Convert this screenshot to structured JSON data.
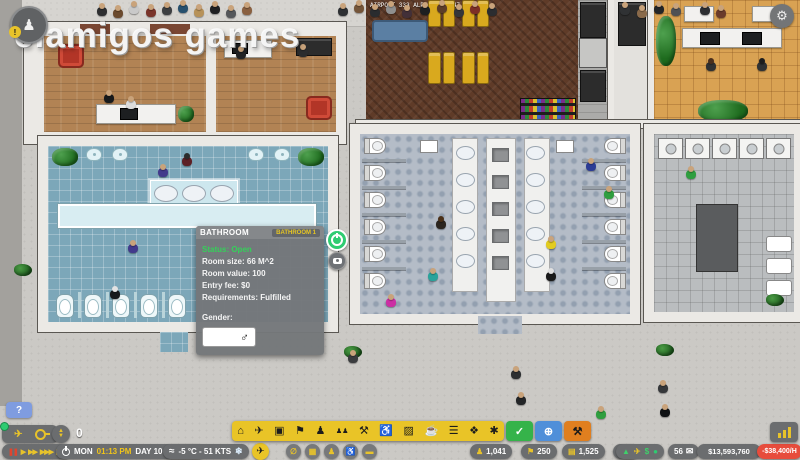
{
  "watermark": "elamigos  games",
  "world": {
    "flight_label": "AIRPORT 333 ALPHA 33.7-47"
  },
  "panel": {
    "title": "BATHROOM",
    "badge": "BATHROOM 1",
    "status": "Status: Open",
    "lines": [
      "Room size: 66 M^2",
      "Room value: 100",
      "Entry fee: $0",
      "Requirements: Fulfilled"
    ],
    "gender_label": "Gender:",
    "gender_symbol": "♂"
  },
  "hud": {
    "help_label": "?",
    "stepper_value": "0",
    "playback": [
      {
        "name": "pause",
        "glyph": "❚❚",
        "color": "#e0452e"
      },
      {
        "name": "play",
        "glyph": "▶",
        "color": "#e8c32a"
      },
      {
        "name": "speed-2x",
        "glyph": "▶▶",
        "color": "#e8c32a"
      },
      {
        "name": "speed-3x",
        "glyph": "▶▶▶",
        "color": "#e8c32a"
      },
      {
        "name": "skip",
        "glyph": "▶❚",
        "color": "#e8c32a"
      }
    ],
    "clock": {
      "day": "MON",
      "time": "01:13 PM",
      "date": "DAY 10 (YEAR 2)"
    },
    "weather": {
      "wind_glyph": "≈",
      "text": "-5 °C - 51 KTS",
      "snow_glyph": "❄"
    },
    "toolbar": [
      {
        "name": "terminal",
        "glyph": "⌂"
      },
      {
        "name": "flights",
        "glyph": "✈"
      },
      {
        "name": "transit",
        "glyph": "▣"
      },
      {
        "name": "check-in",
        "glyph": "⚑"
      },
      {
        "name": "staff",
        "glyph": "♟"
      },
      {
        "name": "queues",
        "glyph": "♟♟"
      },
      {
        "name": "services",
        "glyph": "⚒"
      },
      {
        "name": "seating",
        "glyph": "♿"
      },
      {
        "name": "facilities",
        "glyph": "▨"
      },
      {
        "name": "food",
        "glyph": "☕"
      },
      {
        "name": "benches",
        "glyph": "☰"
      },
      {
        "name": "shops",
        "glyph": "❖"
      },
      {
        "name": "decorations",
        "glyph": "✱"
      }
    ],
    "mode_buttons": [
      {
        "name": "inspect",
        "glyph": "✓",
        "color": "#35b34a",
        "fg": "#ffffff"
      },
      {
        "name": "grid-view",
        "glyph": "⊕",
        "color": "#4f8fd9",
        "fg": "#ffffff"
      },
      {
        "name": "bulldoze",
        "glyph": "⚒",
        "color": "#e07f1f",
        "fg": "#1a1a1a"
      }
    ],
    "quick_buttons": [
      {
        "name": "zones",
        "glyph": "∅"
      },
      {
        "name": "grid",
        "glyph": "▦"
      },
      {
        "name": "staff-view",
        "glyph": "♟"
      },
      {
        "name": "pax-view",
        "glyph": "♿"
      },
      {
        "name": "filters",
        "glyph": "▬"
      }
    ],
    "airplane_button_glyph": "✈",
    "stats": [
      {
        "name": "passengers",
        "icon": "♟",
        "value": "1,041"
      },
      {
        "name": "staff-count",
        "icon": "⚑",
        "value": "250"
      },
      {
        "name": "bags",
        "icon": "▤",
        "value": "1,525"
      },
      {
        "name": "flights-count",
        "icon": "✈",
        "value": "8"
      }
    ],
    "indicators": [
      {
        "name": "trend-up",
        "glyph": "▲",
        "color": "#3fd06a"
      },
      {
        "name": "plane-status",
        "glyph": "✈",
        "color": "#e8c32a"
      },
      {
        "name": "revenue",
        "glyph": "$",
        "color": "#3fd06a"
      },
      {
        "name": "ok-dot",
        "glyph": "●",
        "color": "#2ecc71"
      }
    ],
    "mail_count": "56",
    "mail_glyph": "✉",
    "balance": "$13,593,760",
    "cash_rate": "-$38,400/H"
  },
  "scene": {
    "people": [
      {
        "x": 97,
        "y": 3,
        "c": "#2e2f31"
      },
      {
        "x": 113,
        "y": 5,
        "c": "#6b4a2e"
      },
      {
        "x": 129,
        "y": 1,
        "c": "#c9c9c9"
      },
      {
        "x": 146,
        "y": 4,
        "c": "#7a342a"
      },
      {
        "x": 162,
        "y": 2,
        "c": "#3d3f42"
      },
      {
        "x": 178,
        "y": 0,
        "c": "#27506e"
      },
      {
        "x": 194,
        "y": 4,
        "c": "#b79259"
      },
      {
        "x": 210,
        "y": 1,
        "c": "#1f2022"
      },
      {
        "x": 226,
        "y": 5,
        "c": "#55575a"
      },
      {
        "x": 242,
        "y": 2,
        "c": "#8a6040"
      },
      {
        "x": 338,
        "y": 3,
        "c": "#2e3033"
      },
      {
        "x": 354,
        "y": 0,
        "c": "#74553a"
      },
      {
        "x": 370,
        "y": 4,
        "c": "#2a2c2f"
      },
      {
        "x": 386,
        "y": 1,
        "c": "#8f8f8f"
      },
      {
        "x": 402,
        "y": 5,
        "c": "#423038"
      },
      {
        "x": 420,
        "y": 2,
        "c": "#1d1f21"
      },
      {
        "x": 437,
        "y": 0,
        "c": "#5c3d28"
      },
      {
        "x": 454,
        "y": 4,
        "c": "#33363a"
      },
      {
        "x": 470,
        "y": 1,
        "c": "#7c2f26"
      },
      {
        "x": 487,
        "y": 3,
        "c": "#2b2d30"
      },
      {
        "x": 620,
        "y": 2,
        "c": "#303234"
      },
      {
        "x": 637,
        "y": 5,
        "c": "#8a6a4a"
      },
      {
        "x": 654,
        "y": 1,
        "c": "#232527"
      },
      {
        "x": 671,
        "y": 3,
        "c": "#4f5154"
      },
      {
        "x": 700,
        "y": 2,
        "c": "#2d2f32"
      },
      {
        "x": 716,
        "y": 5,
        "c": "#6a3b2b"
      },
      {
        "x": 104,
        "y": 90,
        "c": "#17191b"
      },
      {
        "x": 126,
        "y": 96,
        "c": "#dcdcdc"
      },
      {
        "x": 236,
        "y": 46,
        "c": "#202225"
      },
      {
        "x": 298,
        "y": 44,
        "c": "#2a2c2e"
      },
      {
        "x": 706,
        "y": 58,
        "c": "#2f3133",
        "h": "#4a2f1d"
      },
      {
        "x": 757,
        "y": 58,
        "c": "#303234",
        "h": "#1d1d1d"
      },
      {
        "x": 158,
        "y": 164,
        "c": "#423a8c"
      },
      {
        "x": 182,
        "y": 153,
        "c": "#5d2026",
        "h": "#2b2b2b"
      },
      {
        "x": 128,
        "y": 240,
        "c": "#423a8c"
      },
      {
        "x": 110,
        "y": 286,
        "c": "#17191c",
        "h": "#e3e3e3"
      },
      {
        "x": 436,
        "y": 216,
        "c": "#2b251f",
        "h": "#4a3018"
      },
      {
        "x": 428,
        "y": 268,
        "c": "#2aa39b"
      },
      {
        "x": 386,
        "y": 294,
        "c": "#cc2fa4"
      },
      {
        "x": 586,
        "y": 158,
        "c": "#2c3c95"
      },
      {
        "x": 604,
        "y": 186,
        "c": "#2f9e3f"
      },
      {
        "x": 546,
        "y": 236,
        "c": "#e3cc1f"
      },
      {
        "x": 546,
        "y": 268,
        "c": "#1a1a1a",
        "h": "#e0e0e0"
      },
      {
        "x": 686,
        "y": 166,
        "c": "#2f9e3f"
      },
      {
        "x": 348,
        "y": 350,
        "c": "#3a3c3e"
      },
      {
        "x": 511,
        "y": 366,
        "c": "#2c2e30"
      },
      {
        "x": 516,
        "y": 392,
        "c": "#232527"
      },
      {
        "x": 596,
        "y": 406,
        "c": "#2f9e3f"
      },
      {
        "x": 658,
        "y": 380,
        "c": "#35373a"
      },
      {
        "x": 660,
        "y": 404,
        "c": "#101214"
      }
    ],
    "bushes": [
      {
        "x": 14,
        "y": 264
      },
      {
        "x": 344,
        "y": 346
      },
      {
        "x": 656,
        "y": 344
      },
      {
        "x": 766,
        "y": 294
      }
    ]
  }
}
